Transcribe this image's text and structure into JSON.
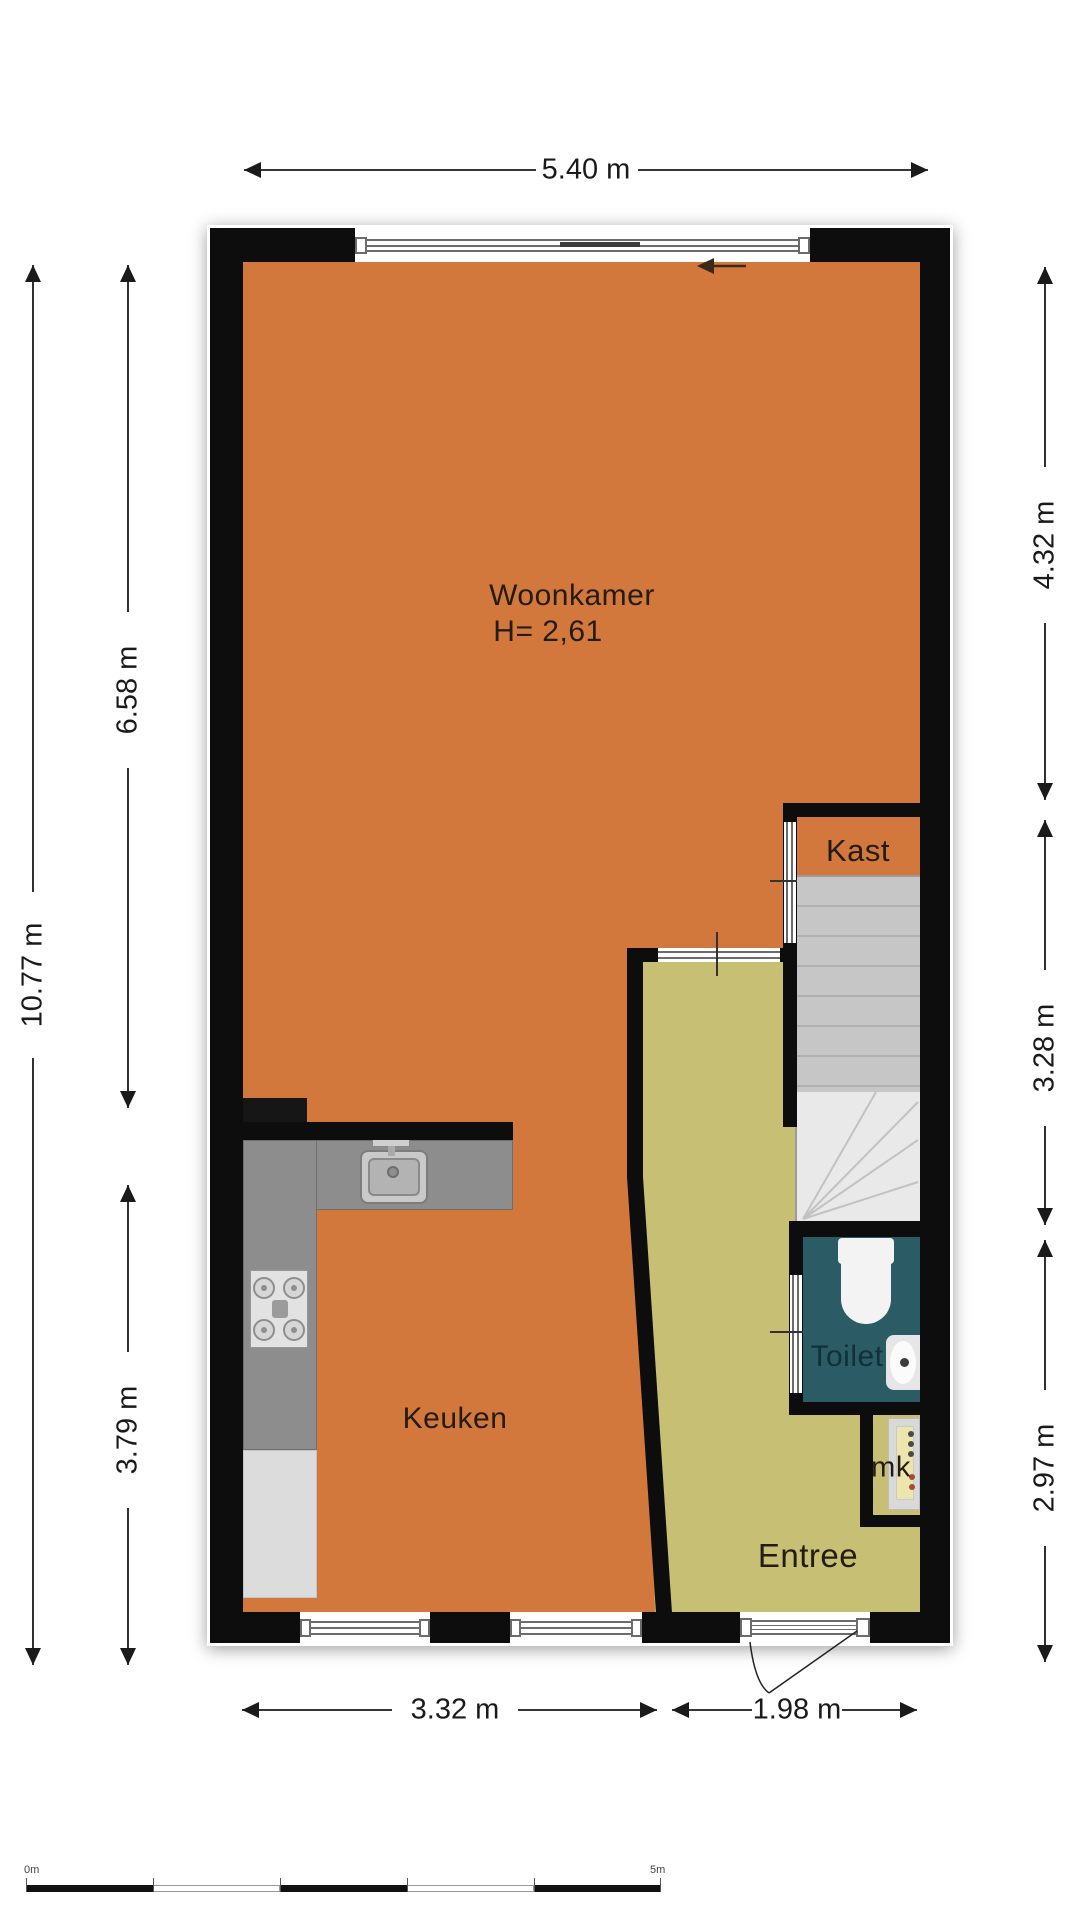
{
  "floor_plan": {
    "rooms": {
      "woonkamer": {
        "label": "Woonkamer",
        "height_label": "H= 2,61"
      },
      "keuken": {
        "label": "Keuken"
      },
      "entree": {
        "label": "Entree"
      },
      "toilet": {
        "label": "Toilet"
      },
      "kast": {
        "label": "Kast"
      },
      "mk": {
        "label": "mk"
      }
    },
    "dimensions": {
      "top_width": "5.40 m",
      "left_total": "10.77 m",
      "left_upper": "6.58 m",
      "left_lower": "3.79 m",
      "right_upper": "4.32 m",
      "right_middle": "3.28 m",
      "right_lower": "2.97 m",
      "bottom_left": "3.32 m",
      "bottom_right": "1.98 m"
    },
    "scale_bar": {
      "start_label": "0m",
      "end_label": "5m"
    },
    "colors": {
      "floor_main": "#d2783c",
      "floor_hall": "#c7bf73",
      "toilet_room": "#2b5c66",
      "walls": "#0d0d0d",
      "stairs": "#d9d9d9",
      "counter": "#8d8d8d"
    }
  }
}
